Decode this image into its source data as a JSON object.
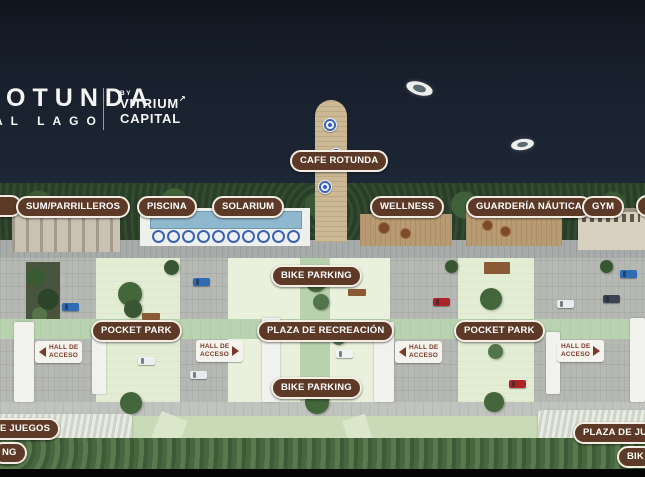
{
  "scene": {
    "description": "Aerial masterplan rendering of lakeside development",
    "colors": {
      "water": "#18202d",
      "pill_background": "#5d3a27",
      "pill_border": "#f3ede4",
      "pill_text": "#ffffff",
      "hall_label_background": "#f4f3ee",
      "hall_label_text": "#7a3a28",
      "courtyard_green": "#e2edd4",
      "promenade_green": "#b9d3b0",
      "ground_gray": "#b6b8b4"
    }
  },
  "brand": {
    "logo_line1": "ROTUNDA",
    "logo_line2": "AL LAGO",
    "by": "BY",
    "name_line1": "VITRIUM",
    "name_line2": "CAPITAL",
    "arrow": "↗"
  },
  "pills": {
    "sum": "SUM/PARRILLEROS",
    "piscina": "PISCINA",
    "solarium": "SOLARIUM",
    "cafe_rotunda": "CAFE ROTUNDA",
    "wellness": "WELLNESS",
    "guarderia_nautica": "GUARDERÍA NÁUTICA",
    "gym": "GYM",
    "bike_parking_top": "BIKE PARKING",
    "pocket_park_left": "POCKET PARK",
    "plaza_de_recreacion": "PLAZA DE RECREACIÓN",
    "pocket_park_right": "POCKET PARK",
    "bike_parking_bottom": "BIKE PARKING",
    "plaza_juegos_left_partial": "E JUEGOS",
    "bike_parking_left_partial": "NG",
    "plaza_juegos_right_partial": "PLAZA DE JU",
    "bike_parking_right_partial": "BIK"
  },
  "hall_label": {
    "line1": "HALL DE",
    "line2": "ACCESO"
  }
}
